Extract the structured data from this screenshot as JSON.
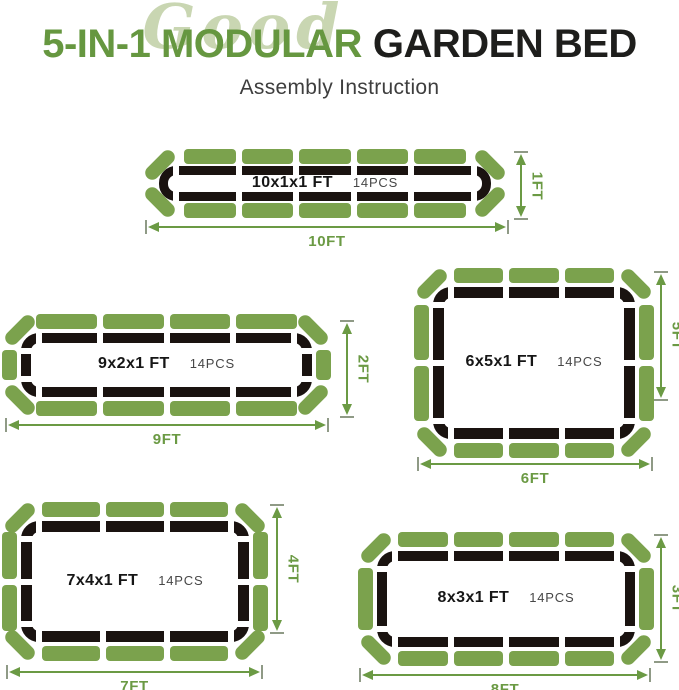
{
  "header": {
    "script_word": "Good",
    "title_green": "5-IN-1 MODULAR",
    "title_dark": "GARDEN BED",
    "subtitle": "Assembly Instruction"
  },
  "colors": {
    "panel_green": "#7ba24d",
    "frame_dark": "#1a1310",
    "dim_green": "#6b9a44",
    "tick_gray": "#8f9a86",
    "title_green": "#669740",
    "title_dark": "#1e1e1c",
    "script_green": "#c9d6b2",
    "subtitle_gray": "#3e3e3e"
  },
  "beds": [
    {
      "id": "10x1x1",
      "size_label": "10x1x1 FT",
      "pcs_label": "14PCS",
      "width_label": "10FT",
      "height_label": "1FT",
      "pieces": {
        "top": 5,
        "bottom": 5,
        "left": 0,
        "right": 0,
        "corners": 4,
        "total": 14
      }
    },
    {
      "id": "9x2x1",
      "size_label": "9x2x1 FT",
      "pcs_label": "14PCS",
      "width_label": "9FT",
      "height_label": "2FT",
      "pieces": {
        "top": 4,
        "bottom": 4,
        "left": 1,
        "right": 1,
        "corners": 4,
        "total": 14
      }
    },
    {
      "id": "6x5x1",
      "size_label": "6x5x1 FT",
      "pcs_label": "14PCS",
      "width_label": "6FT",
      "height_label": "5FT",
      "pieces": {
        "top": 3,
        "bottom": 3,
        "left": 2,
        "right": 2,
        "corners": 4,
        "total": 14
      }
    },
    {
      "id": "7x4x1",
      "size_label": "7x4x1 FT",
      "pcs_label": "14PCS",
      "width_label": "7FT",
      "height_label": "4FT",
      "pieces": {
        "top": 3,
        "bottom": 3,
        "left": 2,
        "right": 2,
        "corners": 4,
        "total": 14
      }
    },
    {
      "id": "8x3x1",
      "size_label": "8x3x1 FT",
      "pcs_label": "14PCS",
      "width_label": "8FT",
      "height_label": "3FT",
      "pieces": {
        "top": 4,
        "bottom": 4,
        "left": 1,
        "right": 1,
        "corners": 4,
        "total": 14
      }
    }
  ]
}
